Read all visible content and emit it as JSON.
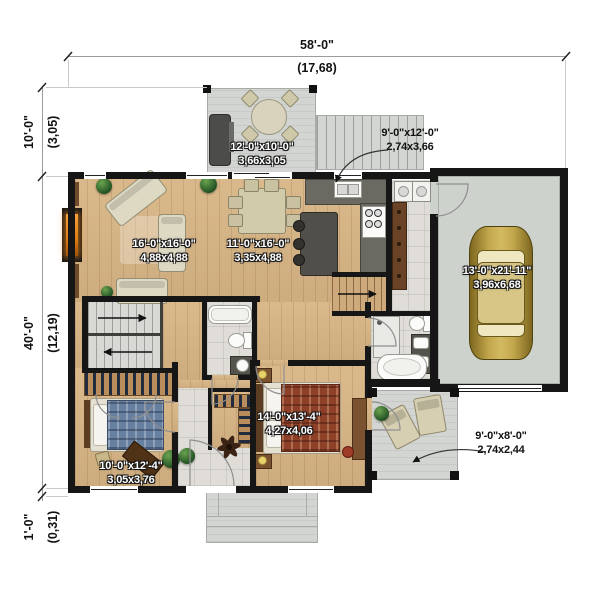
{
  "page": {
    "type": "architectural first-floor plan"
  },
  "dimensions": {
    "overall_width": {
      "imperial": "58'-0\"",
      "metric": "(17,68)"
    },
    "deck_depth": {
      "imperial": "10'-0\"",
      "metric": "(3,05)"
    },
    "house_depth": {
      "imperial": "40'-0\"",
      "metric": "(12,19)"
    },
    "step_depth": {
      "imperial": "1'-0\"",
      "metric": "(0,31)"
    }
  },
  "rooms": {
    "deck": {
      "imperial": "12'-0\"x10'-0\"",
      "metric": "3,66x3,05"
    },
    "kitchen": {
      "imperial": "9'-0\"x12'-0\"",
      "metric": "2,74x3,66"
    },
    "living_room": {
      "imperial": "16'-0\"x16'-0\"",
      "metric": "4,88x4,88"
    },
    "dining_room": {
      "imperial": "11'-0\"x16'-0\"",
      "metric": "3,35x4,88"
    },
    "garage": {
      "imperial": "13'-0\"x21'-11\"",
      "metric": "3,96x6,68"
    },
    "master_bedroom": {
      "imperial": "14'-0\"x13'-4\"",
      "metric": "4,27x4,06"
    },
    "bedroom": {
      "imperial": "10'-0\"x12'-4\"",
      "metric": "3,05x3,76"
    },
    "patio": {
      "imperial": "9'-0\"x8'-0\"",
      "metric": "2,74x2,44"
    }
  },
  "colors": {
    "wall": "#161616",
    "wood_floor": "#d8b585",
    "tile_floor": "#e0ddd8",
    "deck": "#d2d5d1",
    "garage_floor": "#ced2cc",
    "fireplace": "#e8821e",
    "car_body": "#b5973f",
    "counter": "#5b5a53",
    "master_bed": "#8e4029",
    "second_bed": "#68809f",
    "room_label_text": "#ffffff",
    "dimension_text": "#111111"
  }
}
